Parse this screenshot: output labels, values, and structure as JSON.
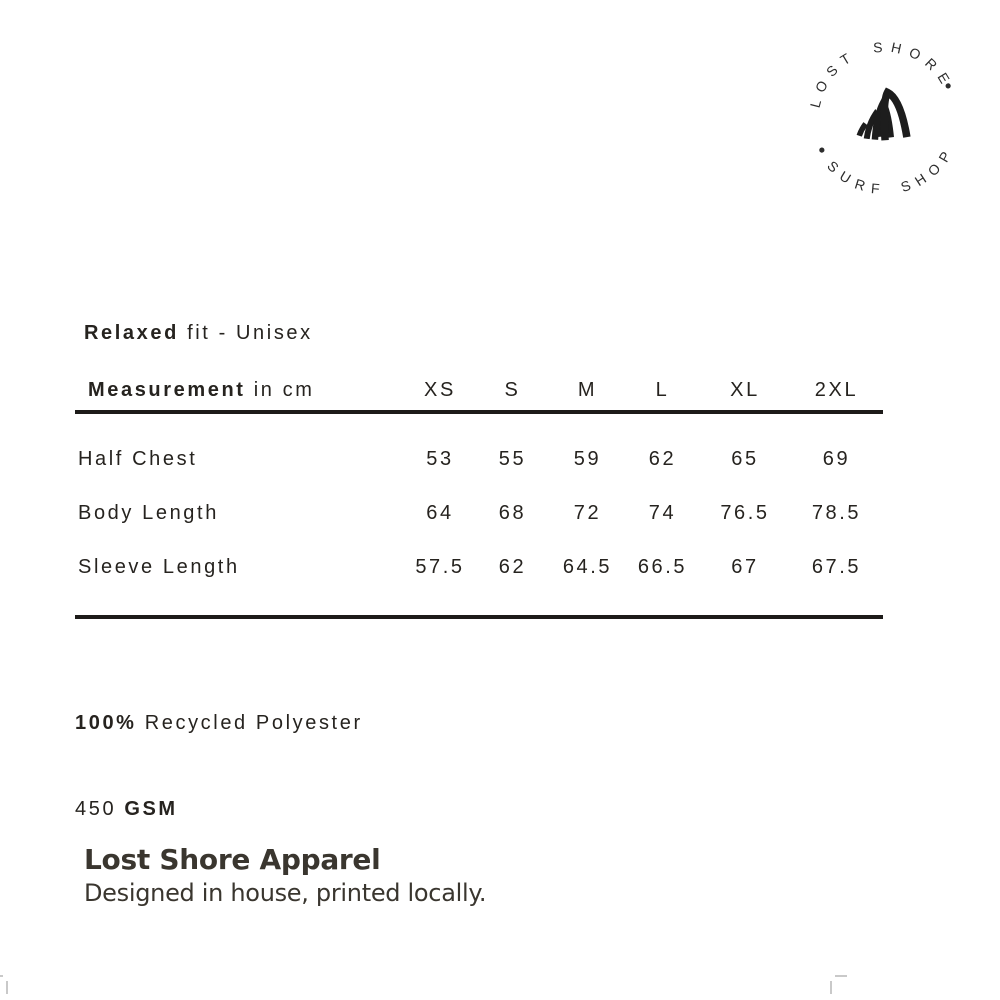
{
  "logo": {
    "top_text": "LOST SHORE",
    "bottom_text": "SURF SHOP",
    "icon": "wave-icon",
    "ink": "#2d2d2d"
  },
  "fit_line": {
    "bold": "Relaxed",
    "rest": " fit - Unisex"
  },
  "size_table": {
    "header_bold": "Measurement",
    "header_rest": " in cm",
    "columns": [
      "XS",
      "S",
      "M",
      "L",
      "XL",
      "2XL"
    ],
    "rows": [
      {
        "label": "Half Chest",
        "values": [
          "53",
          "55",
          "59",
          "62",
          "65",
          "69"
        ]
      },
      {
        "label": "Body Length",
        "values": [
          "64",
          "68",
          "72",
          "74",
          "76.5",
          "78.5"
        ]
      },
      {
        "label": "Sleeve Length",
        "values": [
          "57.5",
          "62",
          "64.5",
          "66.5",
          "67",
          "67.5"
        ]
      }
    ],
    "rule_color": "#1d1b19"
  },
  "fabric": {
    "percent_bold": "100%",
    "material_rest": " Recycled Polyester",
    "weight": "450 ",
    "weight_bold": "GSM"
  },
  "footer": {
    "title": "Lost Shore Apparel",
    "subtitle": "Designed in house, printed locally."
  },
  "colors": {
    "ink": "#26231f",
    "footer_ink": "#3a362f",
    "corner_mark": "#c9c9c9"
  }
}
